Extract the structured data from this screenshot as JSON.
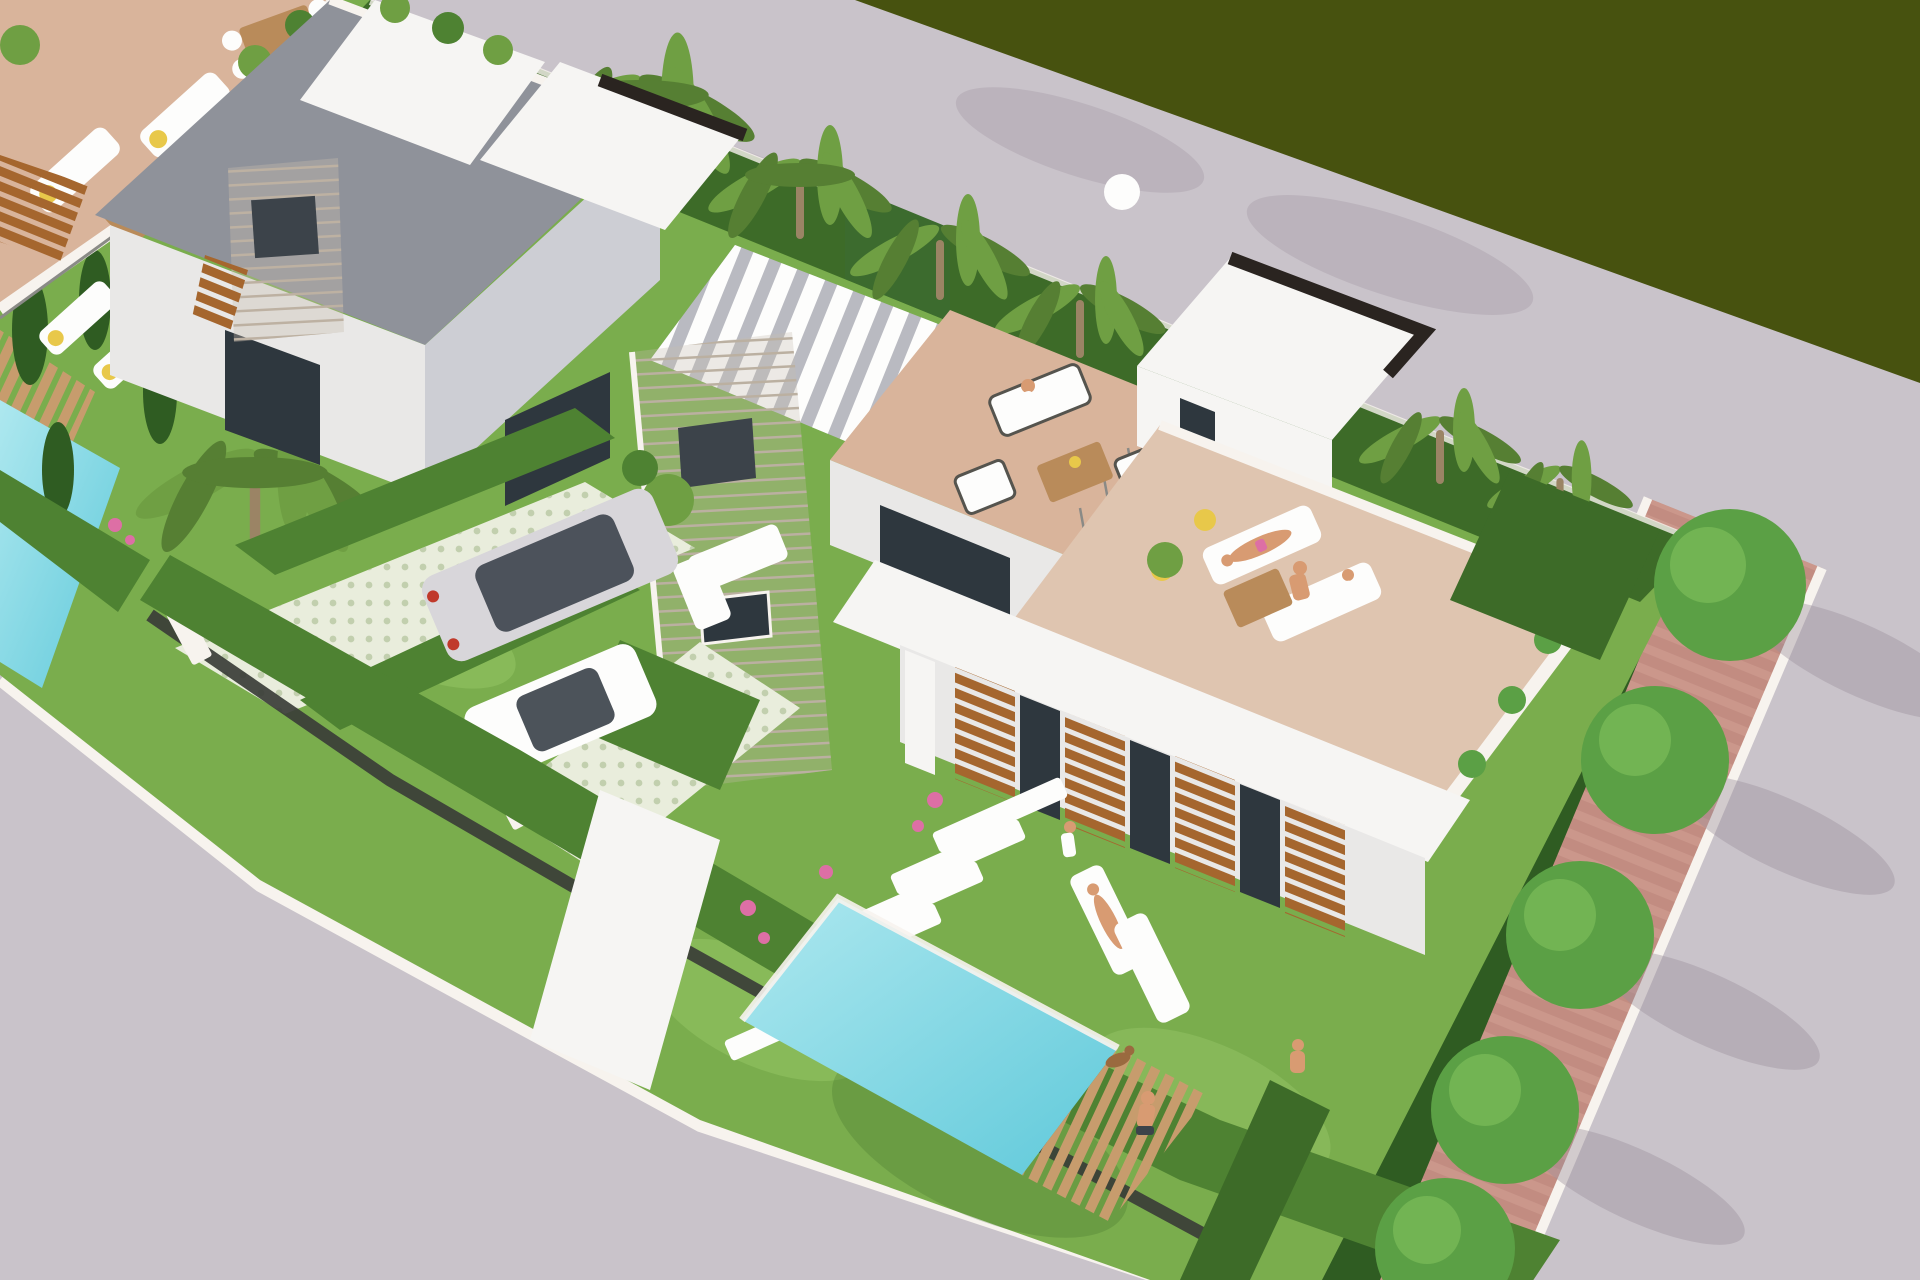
{
  "scene": {
    "house_number": "12"
  },
  "palette": {
    "road": "#c9c3ca",
    "road_shadow": "#9b8f9c",
    "field": "#47520f",
    "sidewalk": "#f4c9a7",
    "curb": "#f7f3ee",
    "brick": "#c28c81",
    "brick_light": "#d2a094",
    "cypress": "#2f5c22",
    "fence": "#3a3d37",
    "grass": "#7aad4d",
    "grass_light": "#93c465",
    "hedge": "#4e8232",
    "hedge_dark": "#3d6b28",
    "ivy": "#3c6b2e",
    "wall_white": "#f6f5f3",
    "wall_light": "#e9e8e7",
    "wall_shade": "#cdced4",
    "roof_gray": "#8f929a",
    "parapet_black": "#2a2420",
    "stone": "#c8beb0",
    "stone_shade": "#b7ab9b",
    "grille": "#3c434a",
    "glass": "#2e373e",
    "wood": "#a5662e",
    "wood_dark": "#7c4a1f",
    "deck_wood": "#a87c4f",
    "deck_light": "#c79c6d",
    "drive_base": "#e9eddc",
    "drive_dot": "#c2cfae",
    "pool_light": "#aee8ef",
    "pool_deep": "#5fc9da",
    "terrace_tile": "#d9b49b",
    "deck_tile": "#dfc5b0",
    "slat_gap": "#b9bac1",
    "white": "#fdfdfc",
    "furniture_frame": "#55544e",
    "table_wood": "#b98b5a",
    "skin": "#d89b72",
    "towel_yellow": "#e8c84a",
    "flower_pink": "#dd6fa5",
    "palm_green": "#6f9f43",
    "palm_dark": "#567f33",
    "palm_trunk": "#9b8465",
    "tree_green": "#5ba045",
    "tree_light": "#79bb58",
    "silver": "#d8d6da",
    "car_window": "#3d444c",
    "tail_red": "#c0392b",
    "dog_brown": "#9a6a3f",
    "rail_gray": "#8a8a86"
  }
}
